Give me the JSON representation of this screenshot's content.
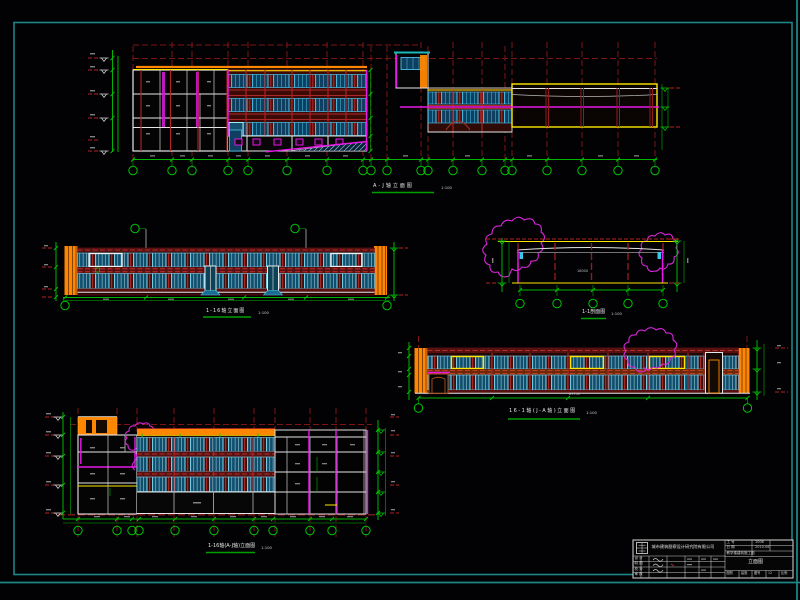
{
  "palette": {
    "background": "#020205",
    "frame": "#1d8585",
    "grid_red_dark": "#7e1414",
    "bright_red": "#d23434",
    "maroon_wall": "#571110",
    "orange": "#ff8600",
    "yellow": "#ffe800",
    "magenta": "#e818e8",
    "cyan_frame": "#49c3e8",
    "window_blue": "#0f4f6e",
    "dim_green": "#00b400",
    "white_line": "#e6e6e6"
  },
  "drawings": {
    "top": {
      "title": "A-J轴立面图",
      "scale": "1:100"
    },
    "mid_left": {
      "title": "1-16轴立面图",
      "scale": "1:100"
    },
    "section": {
      "title": "1-1剖面图",
      "scale": "1:100"
    },
    "mid_right": {
      "title": "16-1轴(J-A轴)立面图",
      "scale": "1:100"
    },
    "bottom_left": {
      "title": "1-16轴(A-J轴)立面图",
      "scale": "1:100"
    }
  },
  "dims": {
    "section_width": "18000",
    "right_total": "83740"
  },
  "title_block": {
    "company": "城市建筑勘察设计研究院有限公司",
    "rows": {
      "design": "设 计",
      "draft": "制 图",
      "check": "校 对",
      "review": "审 核"
    },
    "job_label": "工 号",
    "job_value": "1006",
    "date_label": "日 期",
    "date_value": "2010.06",
    "project": "教学楼建筑施工图",
    "drawing_name": "立面图",
    "sheet": {
      "cat_label": "图别",
      "cat": "建施",
      "no_label": "图号",
      "no": "12",
      "scale_label": "比例"
    }
  }
}
